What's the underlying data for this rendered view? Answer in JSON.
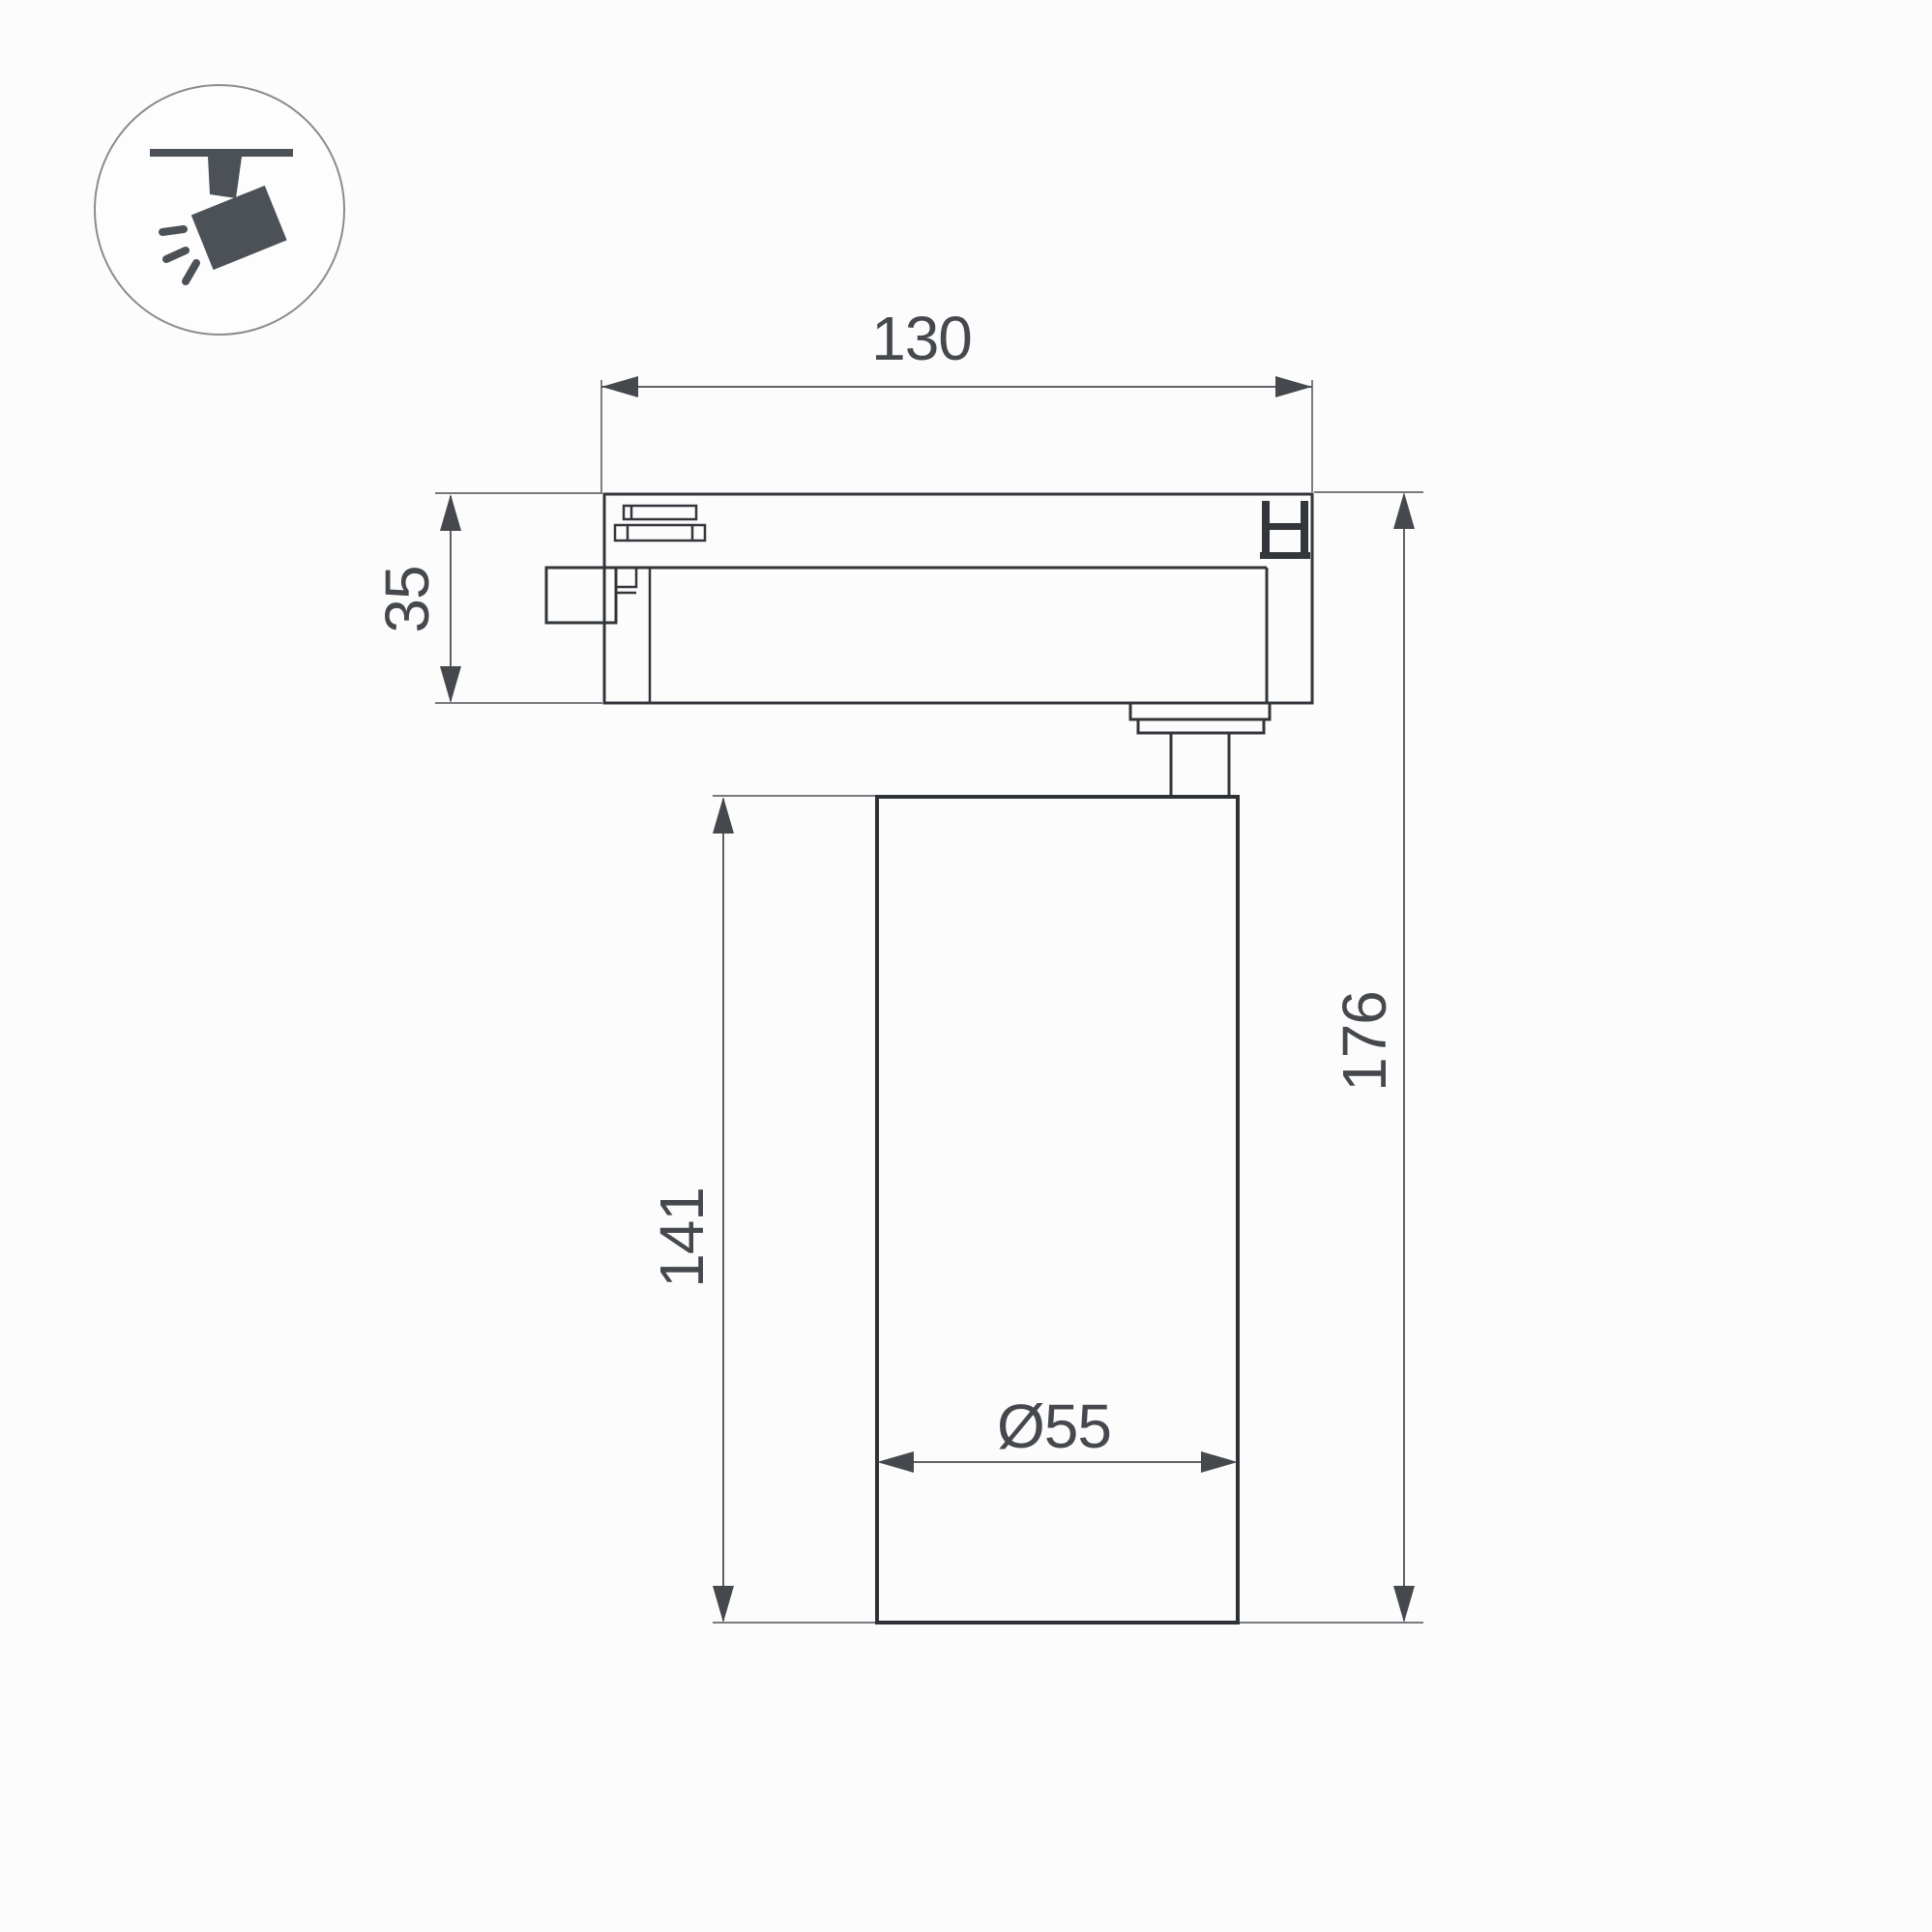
{
  "colors": {
    "background": "#fcfcfc",
    "outline": "#32363a",
    "dimension_line": "#5d6165",
    "dimension_text": "#45494d",
    "icon_glyph": "#4b5156"
  },
  "icon": {
    "name": "track-spotlight-pictogram"
  },
  "dimensions": {
    "track_width": "130",
    "track_height": "35",
    "body_height": "141",
    "total_height": "176",
    "body_diameter": "Ø55"
  }
}
